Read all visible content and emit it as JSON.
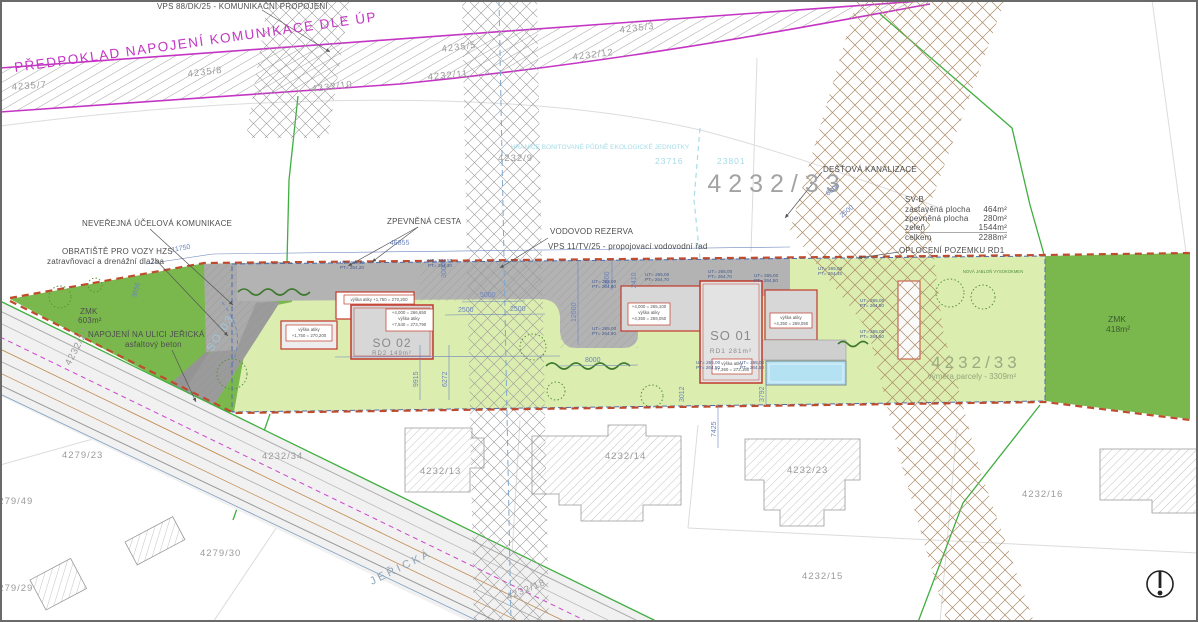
{
  "annotations": {
    "vps_top": "VPS 88/DK/25 - KOMUNIKAČNÍ PROPOJENÍ",
    "predpoklad": "PŘEDPOKLAD NAPOJENÍ KOMUNIKACE DLE ÚP",
    "bpej_title": "HRANICE BONITOVANÉ PŮDNĚ EKOLOGICKÉ JEDNOTKY",
    "bpej_code1": "23716",
    "bpej_code2": "23801",
    "destova": "DEŠŤOVÁ KANALIZACE",
    "oploceni": "OPLOCENÍ POZEMKU RD1",
    "neverejna": "NEVEŘEJNÁ ÚČELOVÁ KOMUNIKACE",
    "obratiste": "OBRATIŠTĚ PRO VOZY HZS",
    "zatravnovaci": "zatravňovací a drenážní dlažba",
    "zpevnena": "ZPEVNĚNÁ CESTA",
    "vodovod1": "VODOVOD REZERVA",
    "vodovod2": "VPS 11/TV/25 - propojovací vodovodní řad",
    "napojeni1": "NAPOJENÍ NA ULICI JEŘICKÁ",
    "napojeni2": "asfaltový beton",
    "nova_jablon": "NOVÁ JABLOŇ VYSOKOKMEN"
  },
  "svb": {
    "title": "SV-B",
    "rows": [
      {
        "k": "zastavěná plocha",
        "v": "464m²"
      },
      {
        "k": "zpevněná plocha",
        "v": "280m²"
      },
      {
        "k": "zeleň",
        "v": "1544m²"
      },
      {
        "k": "celkem",
        "v": "2288m²"
      }
    ]
  },
  "zmk_left": {
    "l1": "ZMK",
    "l2": "603m²"
  },
  "zmk_right": {
    "l1": "ZMK",
    "l2": "418m²"
  },
  "plot": {
    "number": "4232/33",
    "area": "výměra parcely - 3309m²"
  },
  "buildings": {
    "so01": {
      "code": "SO 01",
      "area": "RD1 281m²"
    },
    "so02": {
      "code": "SO 02",
      "area": "RD2 149m²"
    },
    "so03": "SO 03"
  },
  "atika": [
    {
      "l1": "výška atiky  +1,750 = 270,200"
    },
    {
      "l1": "+4,000 = 266,650",
      "l2": "výška atiky",
      "l3": "+7,540 = 273,790"
    },
    {
      "l1": "výška atiky",
      "l2": "+1,750 = 270,200"
    },
    {
      "l1": "+4,000 = 265,100",
      "l2": "výška atiky",
      "l3": "+4,350 = 269,050"
    },
    {
      "l1": "výška atiky",
      "l2": "+7,360 = 272,160"
    },
    {
      "l1": "výška atiky",
      "l2": "+4,350 = 269,050"
    }
  ],
  "elevations": [
    {
      "ut": "UT= 264,30",
      "pt": "PT= 264,20"
    },
    {
      "ut": "UT= 264,50",
      "pt": "PT= 264,30"
    },
    {
      "ut": "UT= 265,00",
      "pt": "PT= 264,80"
    },
    {
      "ut": "UT= 265,00",
      "pt": "PT= 264,90"
    },
    {
      "ut": "UT= 265,00",
      "pt": "PT= 264,70"
    },
    {
      "ut": "UT= 265,00",
      "pt": "PT= 264,70"
    },
    {
      "ut": "UT= 265,00",
      "pt": "PT= 264,50"
    },
    {
      "ut": "UT= 265,00",
      "pt": "PT= 264,45"
    },
    {
      "ut": "UT= 265,00",
      "pt": "PT= 264,50"
    },
    {
      "ut": "UT= 265,00",
      "pt": "PT= 264,50"
    },
    {
      "ut": "UT= 265,00",
      "pt": "PT= 264,50"
    },
    {
      "ut": "UT= 265,00",
      "pt": "PT= 264,50"
    }
  ],
  "dims": {
    "d11750": "11750",
    "d46855": "46855",
    "d3656": "3656",
    "d5000": "5000",
    "d2500a": "2500",
    "d2500b": "2500",
    "d3000": "3000",
    "d12600": "12600",
    "d3600": "3600",
    "d2410": "2410",
    "d8000": "8000",
    "d9915": "9915",
    "d6272": "6272",
    "d3012": "3012",
    "d3792": "3792",
    "d7425": "7425",
    "d6800": "6800",
    "d2500c": "2500"
  },
  "parcels": {
    "p4235_7": "4235/7",
    "p4235_8": "4235/8",
    "p4232_10": "4232/10",
    "p4235_5": "4235/5",
    "p4232_11": "4232/11",
    "p4232_12": "4232/12",
    "p4235_3": "4235/3",
    "p4232_9": "4232/9",
    "p4232_33": "4232/33",
    "p4279_23": "4279/23",
    "p4232_34": "4232/34",
    "p4279_49": "4279/49",
    "p4279_29": "4279/29",
    "p4279_30": "4279/30",
    "p4232_13": "4232/13",
    "p4232_14": "4232/14",
    "p4232_18": "4232/18",
    "p4232_23": "4232/23",
    "p4232_15": "4232/15",
    "p4232_16": "4232/16",
    "p4232_27": "4232/27"
  },
  "street": "JEŘICKÁ",
  "colors": {
    "magenta": "#c435c4",
    "green_border": "#3fae3f",
    "light_green": "#dcedb0",
    "dark_green": "#7ab84e",
    "fence_red": "#bf4b2e",
    "dim_blue": "#6b83bd",
    "cyan": "#a5dce8",
    "road_gray": "#b3b3b3",
    "pool_blue": "#b5e2f2",
    "building_red": "#c0392b"
  }
}
